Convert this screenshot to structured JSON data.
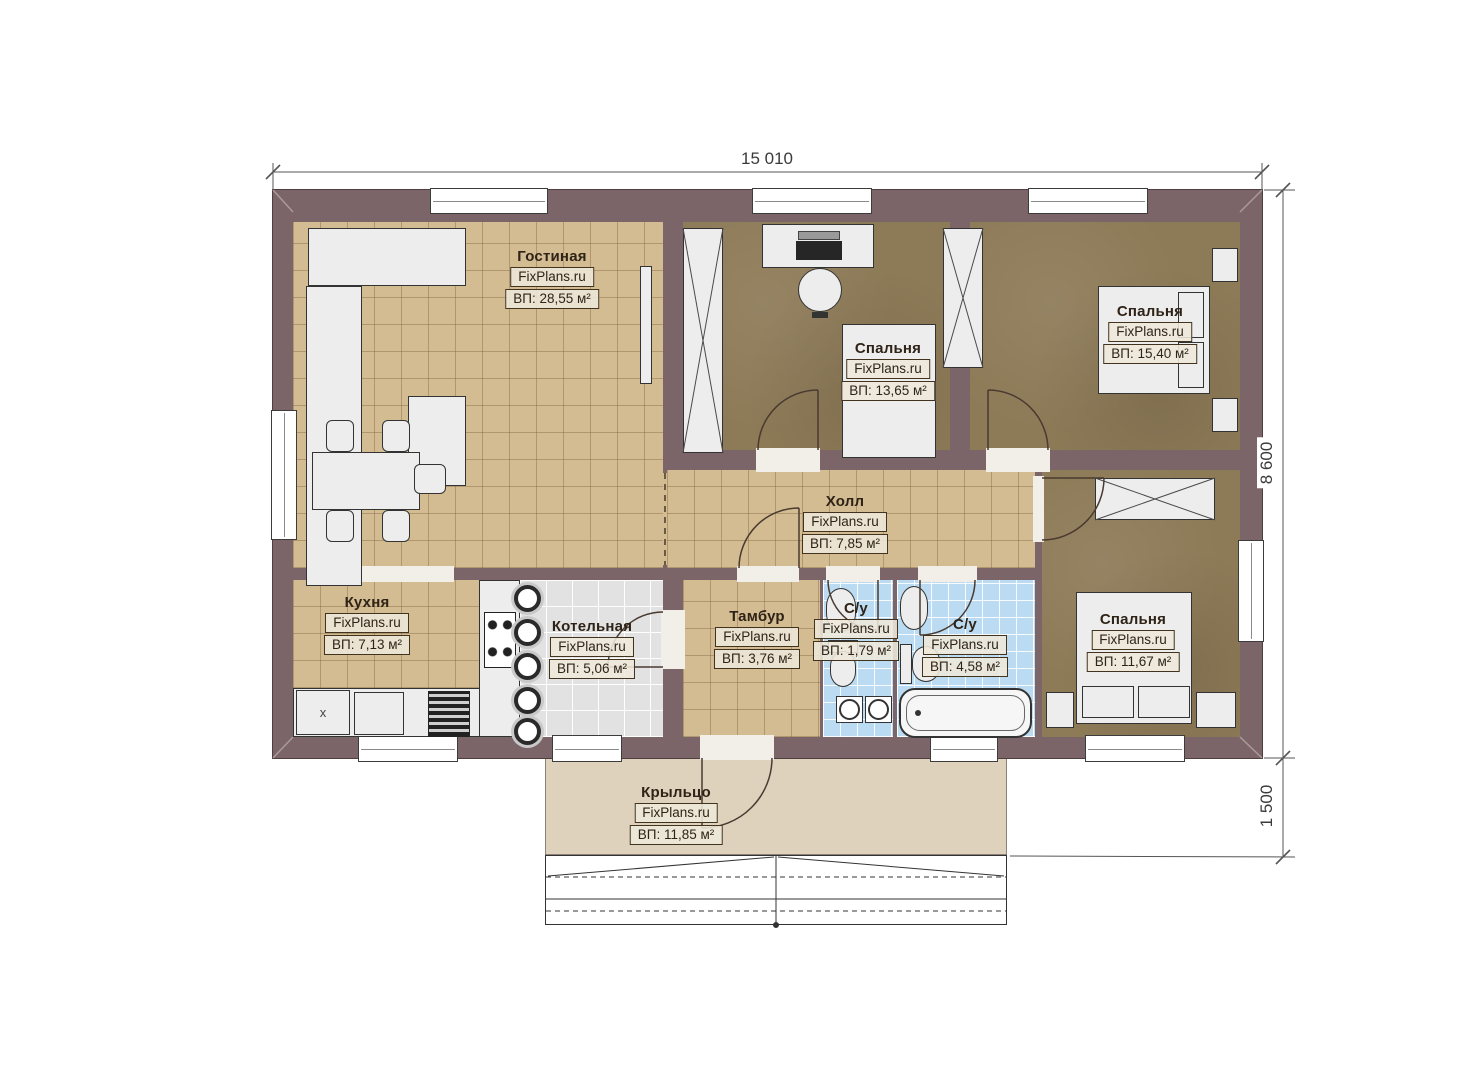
{
  "plan_title": "Floor plan (FixPlans.ru)",
  "dimensions": {
    "top_width": "15 010",
    "right_height": "8 600",
    "porch_height": "1 500"
  },
  "rooms": [
    {
      "id": "living",
      "name": "Гостиная",
      "watermark": "FixPlans.ru",
      "area": "ВП: 28,55 м²"
    },
    {
      "id": "bedroom13",
      "name": "Спальня",
      "watermark": "FixPlans.ru",
      "area": "ВП: 13,65 м²"
    },
    {
      "id": "bedroom15",
      "name": "Спальня",
      "watermark": "FixPlans.ru",
      "area": "ВП: 15,40 м²"
    },
    {
      "id": "hall",
      "name": "Холл",
      "watermark": "FixPlans.ru",
      "area": "ВП: 7,85 м²"
    },
    {
      "id": "kitchen",
      "name": "Кухня",
      "watermark": "FixPlans.ru",
      "area": "ВП: 7,13 м²"
    },
    {
      "id": "boiler",
      "name": "Котельная",
      "watermark": "FixPlans.ru",
      "area": "ВП: 5,06 м²"
    },
    {
      "id": "tambur",
      "name": "Тамбур",
      "watermark": "FixPlans.ru",
      "area": "ВП: 3,76 м²"
    },
    {
      "id": "wc-small",
      "name": "С/у",
      "watermark": "FixPlans.ru",
      "area": "ВП: 1,79 м²"
    },
    {
      "id": "wc-big",
      "name": "С/у",
      "watermark": "FixPlans.ru",
      "area": "ВП: 4,58 м²"
    },
    {
      "id": "bedroom11",
      "name": "Спальня",
      "watermark": "FixPlans.ru",
      "area": "ВП: 11,67 м²"
    },
    {
      "id": "porch",
      "name": "Крыльцо",
      "watermark": "FixPlans.ru",
      "area": "ВП: 11,85 м²"
    }
  ],
  "kitchen_cabinet_label": "x",
  "colors": {
    "wall": "#7c6568",
    "tile_beige": "#d3bc92",
    "carpet": "#8d7a57",
    "tile_blue": "#badbf2",
    "tile_gray": "#e2e2e2",
    "porch": "#ded2bc",
    "furn": "#ededed",
    "line": "#333333",
    "label_border": "#42331f",
    "text": "#2f2317"
  }
}
